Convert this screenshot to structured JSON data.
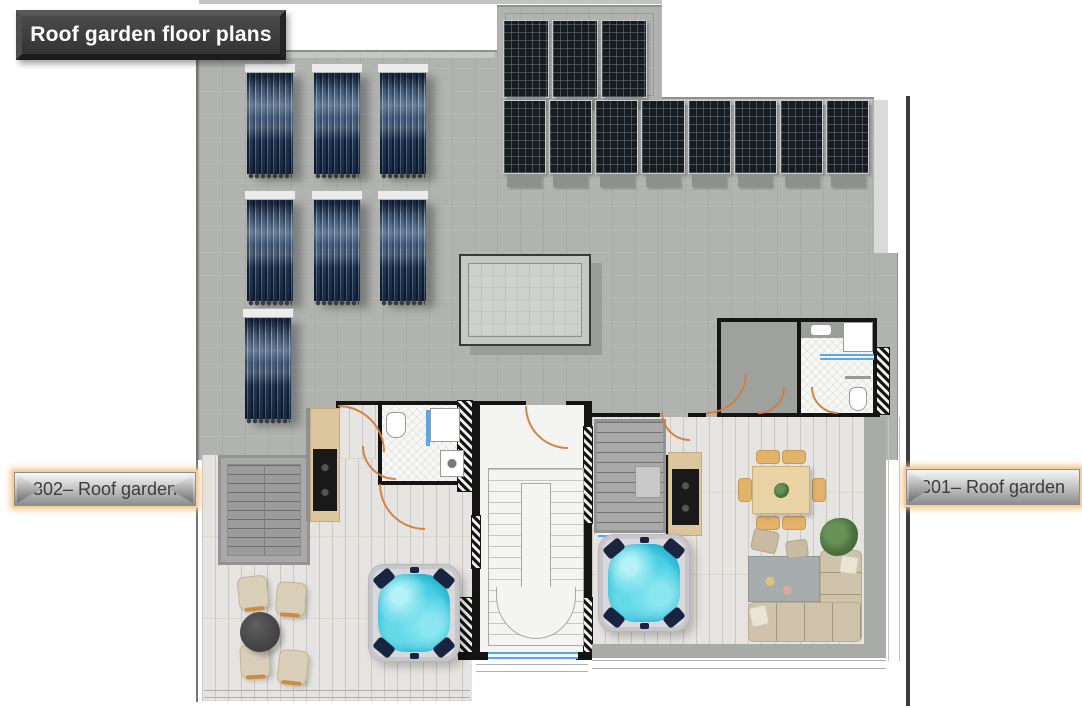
{
  "title_banner": {
    "text": "Roof garden floor plans"
  },
  "unit_labels": {
    "left": "302– Roof garden",
    "right": "301– Roof garden"
  },
  "features": {
    "pv_top_row": 3,
    "pv_long_row": 8,
    "pv_bars_top": 3,
    "pv_bars_long": 8,
    "thermal_collectors_row1": 3,
    "thermal_collectors_row2": 3,
    "thermal_single": 1,
    "hot_tubs": 2,
    "skylights": 1
  },
  "palette": {
    "roof_gray": "#b1b3b1",
    "wood_floor": "#e6e4e0",
    "pv_panel": "#191c1f",
    "thermal_tube": "#2a3f5c",
    "hot_tub_water": "#49cee2",
    "door_arc_orange": "#cf7f3e",
    "window_blue": "#5aa7e8",
    "wall_black": "#141414",
    "banner_bg": "#3d3d3d",
    "label_glow": "#f3c68f"
  }
}
